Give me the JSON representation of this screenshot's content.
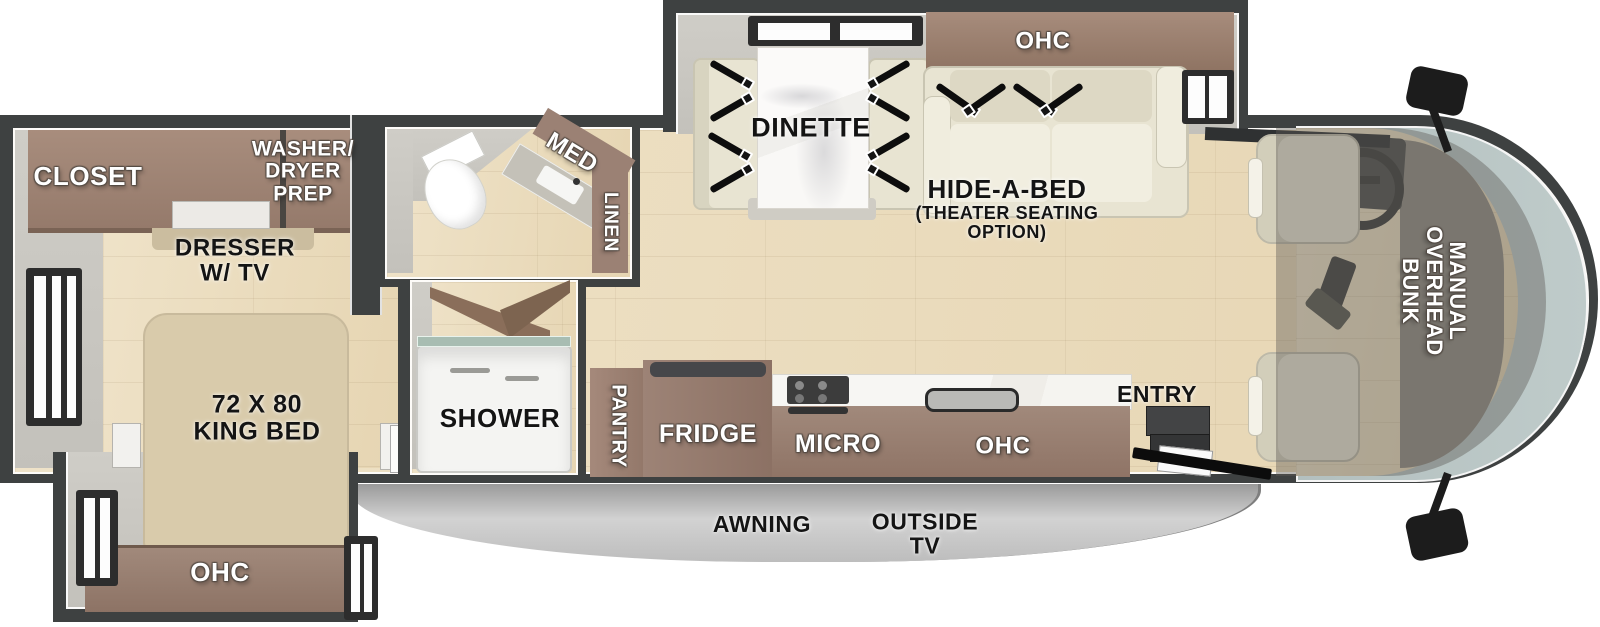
{
  "plan": {
    "labels": {
      "closet": "CLOSET",
      "washer_dryer_prep": [
        "WASHER/",
        "DRYER",
        "PREP"
      ],
      "dresser": [
        "DRESSER",
        "W/ TV"
      ],
      "king_bed": [
        "72 X 80",
        "KING BED"
      ],
      "bedroom_ohc": "OHC",
      "med": "MED",
      "linen": "LINEN",
      "shower": "SHOWER",
      "pantry": "PANTRY",
      "fridge": "FRIDGE",
      "micro": "MICRO",
      "kitchen_ohc": "OHC",
      "dinette": "DINETTE",
      "dinette_ohc": "OHC",
      "hide_a_bed": [
        "HIDE-A-BED",
        "(THEATER SEATING",
        "OPTION)"
      ],
      "entry": "ENTRY",
      "overhead_bunk": [
        "MANUAL",
        "OVERHEAD",
        "BUNK"
      ],
      "awning": "AWNING",
      "outside_tv": [
        "OUTSIDE",
        "TV"
      ]
    },
    "colors": {
      "wall": "#3e4141",
      "floorWood": "#ead9b9",
      "floorGray": "#c9c7c1",
      "cabinet": "#9b8174",
      "cabinetDark": "#7a6355",
      "bed": "#d9cbab",
      "seat": "#e8e4d2",
      "seatTrim": "#c9c5b2",
      "glass": "#b8c5c4",
      "awning": "#c4c4c4",
      "marble": "#f4f3f0",
      "belt": "#0d0d0d"
    }
  }
}
